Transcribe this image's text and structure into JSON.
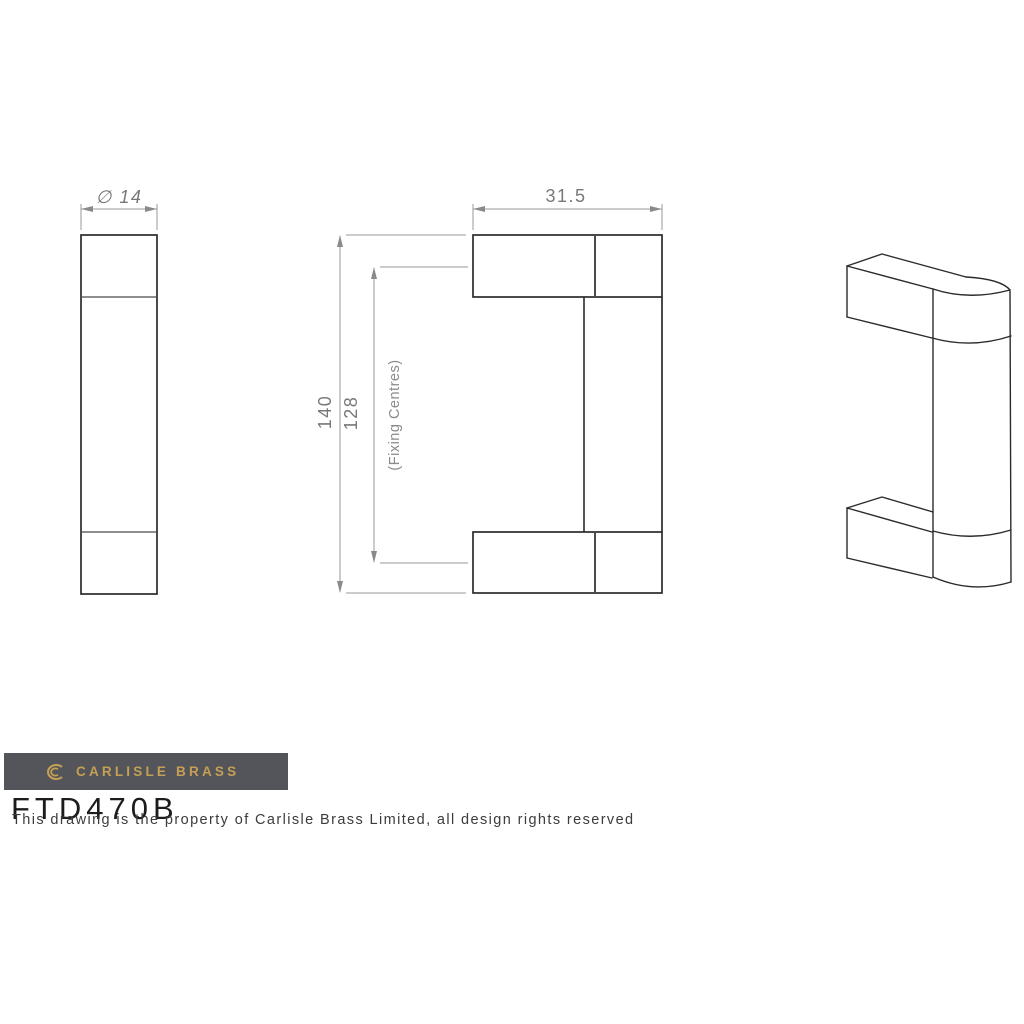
{
  "annotations": {
    "diameter_label": "∅ 14",
    "width_label": "31.5",
    "overall_length_label": "140",
    "fixing_centres_value": "128",
    "fixing_centres_note": "(Fixing Centres)"
  },
  "branding": {
    "brand_name": "CARLISLE BRASS",
    "product_code": "FTD470B",
    "disclaimer": "This drawing is the property of Carlisle Brass Limited, all design rights reserved",
    "banner_color": "#54555a",
    "gold_color": "#c59f54"
  },
  "colors": {
    "background": "#ffffff",
    "part_outline": "#2b2b2b",
    "part_inner_line": "#4a4a4a",
    "dimension_line": "#9a9a9a",
    "dimension_text": "#787878"
  }
}
